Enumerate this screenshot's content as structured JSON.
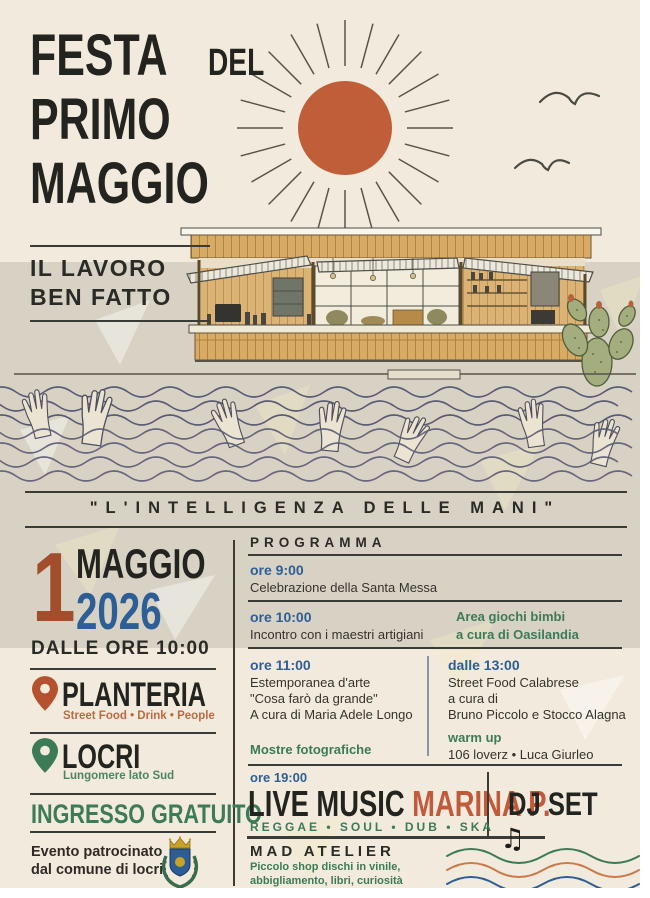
{
  "colors": {
    "cream": "#f2ebdd",
    "gray_band": "#d8d2c5",
    "ink": "#23231f",
    "terracotta": "#b5512f",
    "sun_orange": "#bf5e39",
    "blue": "#2d5e96",
    "green": "#3c7a58",
    "wood": "#d7ab66"
  },
  "header": {
    "title_word1": "FESTA",
    "title_word2": "DEL",
    "title_line2": "PRIMO",
    "title_line3": "MAGGIO",
    "tagline_line1": "IL LAVORO",
    "tagline_line2": "BEN FATTO"
  },
  "quote": "\"L'INTELLIGENZA DELLE MANI\"",
  "details": {
    "day": "1",
    "month": "MAGGIO",
    "year": "2026",
    "start_time": "DALLE ORE 10:00",
    "venue_name": "PLANTERIA",
    "venue_tagline": "Street Food • Drink • People",
    "city_name": "LOCRI",
    "city_tagline": "Lungomere lato Sud",
    "admission": "INGRESSO GRATUITO",
    "patronage_line1": "Evento patrocinato",
    "patronage_line2": "dal comune di locri"
  },
  "program": {
    "header": "PROGRAMMA",
    "slots": [
      {
        "time": "ore 9:00",
        "line1": "Celebrazione della Santa Messa"
      },
      {
        "time": "ore 10:00",
        "line1": "Incontro con i maestri artigiani",
        "side1": "Area giochi bimbi",
        "side2": "a cura di Oasilandia"
      },
      {
        "time": "ore 11:00",
        "line1": "Estemporanea d'arte",
        "line2": "\"Cosa farò da grande\"",
        "line3": "A cura di Maria Adele Longo",
        "green": "Mostre fotografiche"
      },
      {
        "time": "dalle 13:00",
        "line1": "Street Food Calabrese",
        "line2": "a cura di",
        "line3": "Bruno Piccolo e Stocco Alagna",
        "green": "warm up",
        "line4": "106 loverz • Luca Giurleo"
      },
      {
        "time": "ore 19:00"
      }
    ],
    "live_music": "LIVE MUSIC",
    "artist": "MARINA P.",
    "dj_set": "DJ SET",
    "genres": "REGGAE • SOUL • DUB • SKA",
    "atelier_title": "MAD ATELIER",
    "atelier_line1": "Piccolo shop dischi in vinile,",
    "atelier_line2": "abbigliamento, libri, curiosità",
    "atelier_line3": "nuovo e usato"
  },
  "icons": {
    "music_note": "♫",
    "venue_pin": "map-pin",
    "city_pin": "map-pin"
  }
}
